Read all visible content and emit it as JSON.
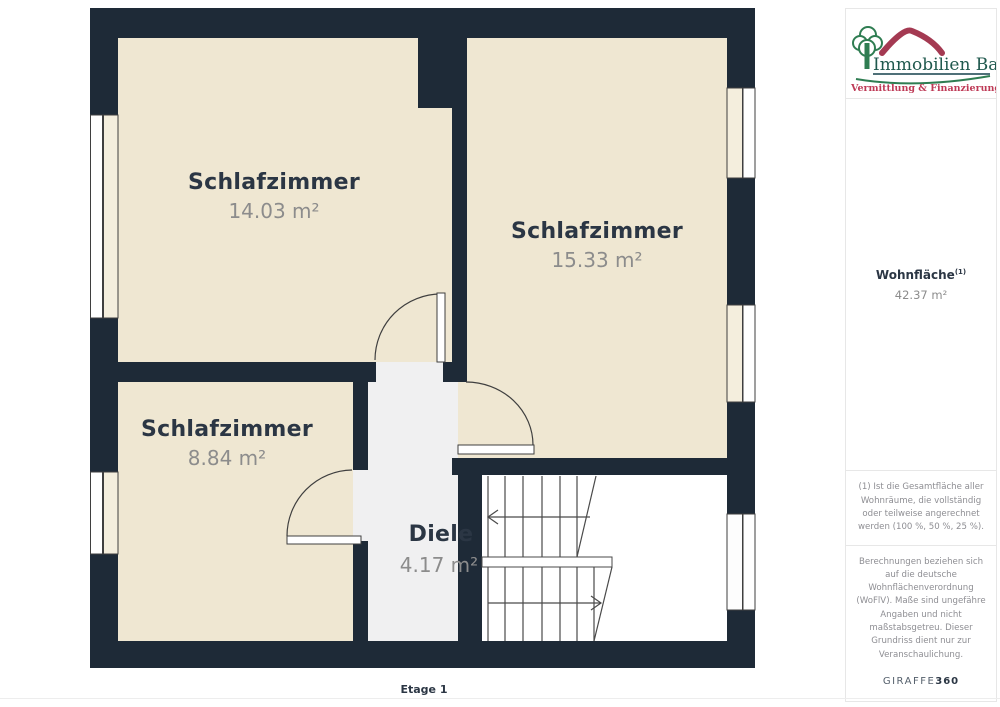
{
  "page": {
    "floor_label": "Etage 1"
  },
  "plan": {
    "rooms": [
      {
        "name": "Schlafzimmer",
        "area": "14.03 m²"
      },
      {
        "name": "Schlafzimmer",
        "area": "15.33 m²"
      },
      {
        "name": "Schlafzimmer",
        "area": "8.84 m²"
      },
      {
        "name": "Diele",
        "area": "4.17 m²"
      }
    ]
  },
  "sidebar": {
    "logo": {
      "title": "Immobilien Bart",
      "subtitle": "Vermittlung & Finanzierung"
    },
    "summary": {
      "label": "Wohnfläche",
      "superscript": "(1)",
      "value": "42.37 m²"
    },
    "footnote1": "(1) Ist die Gesamtfläche aller Wohnräume, die vollständig oder teilweise angerechnet werden (100 %, 50 %, 25 %).",
    "footnote2": "Berechnungen beziehen sich auf die deutsche Wohnflächenverordnung (WoFlV). Maße sind ungefähre Angaben und nicht maßstabsgetreu. Dieser Grundriss dient nur zur Veranschaulichung.",
    "brand": {
      "name": "GIRAFFE",
      "suffix": "360"
    }
  },
  "colors": {
    "wall": "#1E2A37",
    "room": "#EFE7D2",
    "hall": "#F0F0F1",
    "stair": "#FFFFFF",
    "roomname": "#2B3644",
    "areatext": "#8C8C8C",
    "logogreen": "#2F7D52",
    "logoteal": "#20594E",
    "logored": "#BE3A56"
  }
}
